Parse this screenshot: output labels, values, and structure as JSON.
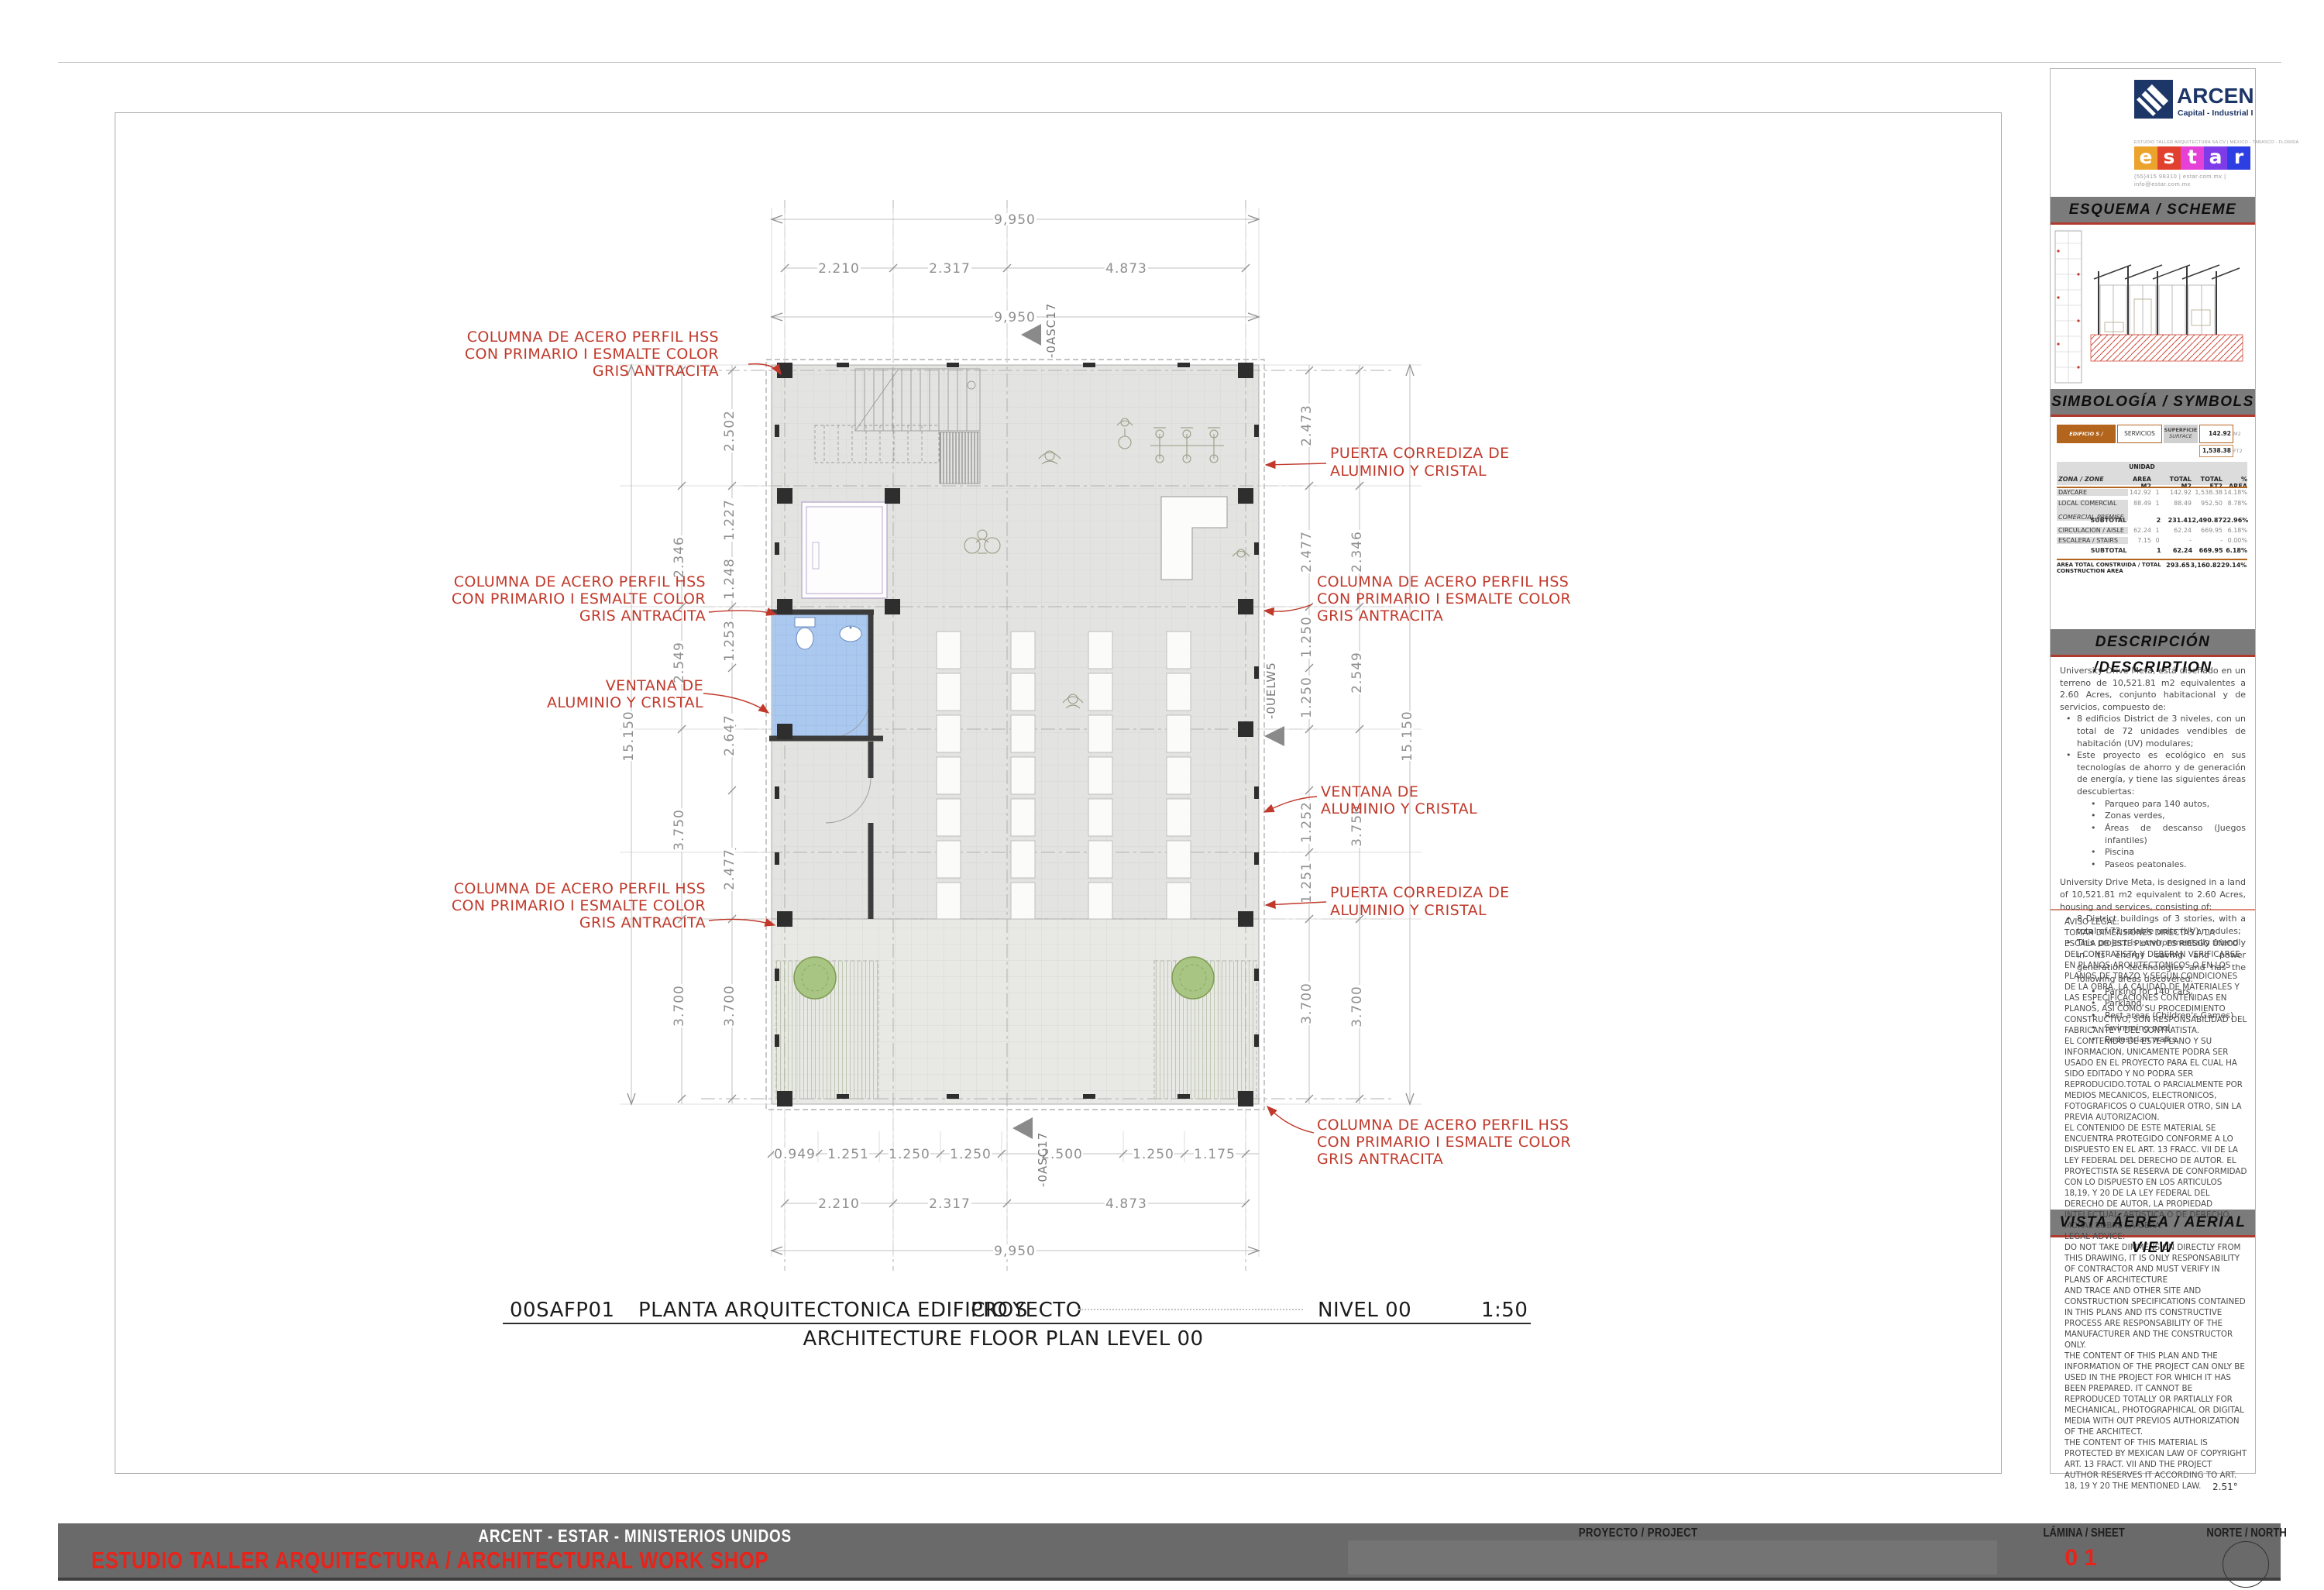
{
  "page": {
    "title_row": {
      "code": "00SAFP01",
      "title": "PLANTA ARQUITECTONICA EDIFICIO S",
      "proyecto": "PROYECTO",
      "level": "NIVEL 00",
      "scale": "1:50",
      "subtitle": "ARCHITECTURE FLOOR PLAN LEVEL 00"
    },
    "north_angle": "2.51°"
  },
  "plan": {
    "dims": {
      "overall": "9,950",
      "main_segments": [
        "2.210",
        "2.317",
        "4.873"
      ],
      "module_segments": [
        "0.949",
        "1.251",
        "1.250",
        "1.250",
        "2.500",
        "1.250",
        "1.175"
      ],
      "left_inner": [
        "2.502",
        "1.227",
        "1.248",
        "1.253",
        "2.647",
        "2.477",
        "3.700"
      ],
      "left_outer": [
        "2.346",
        "2.549",
        "3.750",
        "3.700"
      ],
      "left_total": "15.150",
      "right_inner": [
        "2.473",
        "2.477",
        "1.250",
        "1.250",
        "1.252",
        "1.251",
        "3.700"
      ],
      "right_outer": [
        "2.346",
        "2.549",
        "3.750",
        "3.700"
      ],
      "right_total": "15.150"
    },
    "markers": {
      "vertical_section": "-0ASC17",
      "horizontal_section": "-0UELW5"
    },
    "ann": {
      "column_l1": "COLUMNA DE ACERO PERFIL HSS",
      "column_l2": "CON PRIMARIO I ESMALTE COLOR",
      "column_l3": "GRIS ANTRACITA",
      "window_l1": "VENTANA DE",
      "window_l2": "ALUMINIO Y CRISTAL",
      "door_l1": "PUERTA CORREDIZA DE",
      "door_l2": "ALUMINIO Y CRISTAL"
    }
  },
  "panel": {
    "brand": {
      "arcent_name": "ARCENT",
      "arcent_sub": "Capital - Industrial INC.",
      "estar_top": "ESTUDIO TALLER ARQUITECTURA SA CV | MEXICO - TABASCO - FLORIDA",
      "estar_letters": [
        "e",
        "s",
        "t",
        "a",
        "r"
      ],
      "estar_colors": [
        "#eca32b",
        "#e2402e",
        "#e541d7",
        "#7e3ce8",
        "#2d3fe2"
      ],
      "estar_contact1": "(55)415 98310    |    estar.com.mx   |",
      "estar_contact2": "info@estar.com.mx",
      "accent_red": "#b03a2e",
      "bar_gray": "#7b7b7b"
    },
    "sections": {
      "scheme": "ESQUEMA / SCHEME",
      "symbols": "SIMBOLOGÍA / SYMBOLS",
      "description": "DESCRIPCIÓN /DESCRIPTION",
      "aerial": "VISTA ÁEREA / AERIAL VIEW"
    },
    "table": {
      "building_label": "EDIFICIO S / BUILDING S",
      "building_use": "SERVICIOS",
      "surface_l1": "SUPERFICIE",
      "surface_l2": "SURFACE",
      "surface_m2": "142.92",
      "surface_m2_unit": "M2",
      "surface_ft2": "1,538.38",
      "surface_ft2_unit": "FT2",
      "unidad": "UNIDAD",
      "headers": {
        "zone": "ZONA / ZONE",
        "area": "AREA M2",
        "total_m2": "TOTAL M2",
        "total_ft2": "TOTAL FT2",
        "pct": "% AREA"
      },
      "rows": [
        {
          "zone": "DAYCARE",
          "area": "142.92",
          "unit": "1",
          "total_m2": "142.92",
          "total_ft2": "1,538.38",
          "pct": "14.18%"
        },
        {
          "zone": "LOCAL COMERCIAL",
          "zone2": "COMERCIAL PREMISE",
          "area": "88.49",
          "unit": "1",
          "total_m2": "88.49",
          "total_ft2": "952.50",
          "pct": "8.78%"
        },
        {
          "zone": "SUBTOTAL",
          "area": "",
          "unit": "2",
          "total_m2": "231.41",
          "total_ft2": "2,490.87",
          "pct": "22.96%"
        },
        {
          "zone": "CIRCULACION / AISLE",
          "area": "62.24",
          "unit": "1",
          "total_m2": "62.24",
          "total_ft2": "669.95",
          "pct": "6.18%"
        },
        {
          "zone": "ESCALERA / STAIRS",
          "area": "7.15",
          "unit": "0",
          "total_m2": "-",
          "total_ft2": "-",
          "pct": "0.00%"
        },
        {
          "zone": "SUBTOTAL",
          "area": "",
          "unit": "1",
          "total_m2": "62.24",
          "total_ft2": "669.95",
          "pct": "6.18%"
        },
        {
          "zone": "AREA TOTAL CONSTRUIDA / TOTAL CONSTRUCTION AREA",
          "area": "",
          "unit": "",
          "total_m2": "293.65",
          "total_ft2": "3,160.82",
          "pct": "29.14%"
        }
      ]
    },
    "description": {
      "es_intro": "University Drive Meta, está diseñado en un terreno de 10,521.81 m2 equivalentes a 2.60 Acres, conjunto habitacional y de servicios, compuesto de:",
      "es_b1": "8 edificios District de 3 niveles, con un total de 72 unidades vendibles de habitación (UV) modulares;",
      "es_b2": "Este proyecto es ecológico en sus tecnologías de ahorro y de generación de energía, y tiene las siguientes áreas descubiertas:",
      "es_sub": [
        "Parqueo para 140 autos,",
        "Zonas verdes,",
        "Áreas de descanso (Juegos infantiles)",
        "Piscina",
        "Paseos peatonales."
      ],
      "en_intro": "University Drive Meta, is designed in a land of 10,521.81 m2 equivalent to 2.60 Acres, housing and services, consisting of:",
      "en_b1": "8 District buildings of 3 stories, with a total of 72 salable units (UV) modules;",
      "en_b2": "This project is environmentally friendly in its energy saving and power generation technologies and has the following areas discovered:",
      "en_sub": [
        "Parking for 140 cars,",
        "Parkland,",
        "Rest areas (Children's Games)",
        "Swimming pool.",
        "Pedestrian walks."
      ]
    },
    "legal": {
      "p0": "AVISO LEGAL:",
      "p1": "TOMAR DIMENSIONES DIRECTAS A LA ESCALA DE ESTE PLANO, ES RIESGO UNICO DEL CONTRATISTA Y DEBERAN VERIFICARSE EN PLANOS ARQUITECTONICOS O EN LOS PLANOS DE TRAZO Y SEGÚN CONDICIONES DE LA OBRA. LA CALIDAD DE MATERIALES Y LAS ESPECIFICACIONES CONTENIDAS EN PLANOS, ASI COMO SU PROCEDIMIENTO CONSTRUCTIVO, SON RESPONSABILIDAD DEL FABRICANTE Y DEL CONTRATISTA.",
      "p2": "EL CONTENIDO DE ESTE PLANO Y SU INFORMACION, UNICAMENTE PODRA SER USADO EN EL PROYECTO PARA EL CUAL HA SIDO EDITADO Y NO PODRA SER REPRODUCIDO.TOTAL O PARCIALMENTE POR MEDIOS MECANICOS, ELECTRONICOS, FOTOGRAFICOS O CUALQUIER OTRO, SIN LA PREVIA AUTORIZACION.",
      "p3": "EL CONTENIDO DE ESTE MATERIAL SE ENCUENTRA PROTEGIDO CONFORME A LO DISPUESTO EN EL ART. 13 FRACC. VII DE LA LEY FEDERAL DEL DERECHO DE AUTOR. EL PROYECTISTA SE RESERVA DE CONFORMIDAD CON LO DISPUESTO EN LOS ARTICULOS 18,19, Y 20  DE LA LEY FEDERAL DEL DERECHO DE AUTOR, LA PROPIEDAD INTELECTUAL, ARTISTICA O DE DERECHO MORAL SOBRE LA OBRA.",
      "p4": "LEGAL ADVICE:",
      "p5": "DO NOT TAKE DIMMENSION DIRECTLY FROM THIS DRAWING, IT IS ONLY RESPONSABILITY OF CONTRACTOR AND MUST VERIFY IN PLANS OF ARCHITECTURE",
      "p6": "AND TRACE AND OTHER SITE AND CONSTRUCTION SPECIFICATIONS CONTAINED IN THIS PLANS AND ITS CONSTRUCTIVE PROCESS ARE RESPONSABILITY OF THE MANUFACTURER AND THE CONSTRUCTOR ONLY.",
      "p7": "THE CONTENT OF THIS PLAN AND THE INFORMATION OF THE PROJECT CAN ONLY BE USED IN THE PROJECT FOR WHICH IT HAS BEEN PREPARED. IT CANNOT BE REPRODUCED TOTALLY OR PARTIALLY FOR MECHANICAL, PHOTOGRAPHICAL OR DIGITAL MEDIA WITH OUT PREVIOS AUTHORIZATION OF THE ARCHITECT.",
      "p8": "THE CONTENT OF THIS MATERIAL IS PROTECTED BY MEXICAN LAW OF COPYRIGHT ART. 13 FRACT. VII AND THE PROJECT AUTHOR RESERVES IT ACCORDING TO ART. 18, 19 Y 20 THE MENTIONED LAW."
    }
  },
  "footer": {
    "line1": "ARCENT - ESTAR - MINISTERIOS UNIDOS",
    "line2": "ESTUDIO TALLER ARQUITECTURA  / ARCHITECTURAL WORK SHOP",
    "project_label": "PROYECTO / PROJECT",
    "sheet_label": "LÁMINA / SHEET",
    "sheet_number": "01",
    "north_label": "NORTE / NORTH"
  }
}
